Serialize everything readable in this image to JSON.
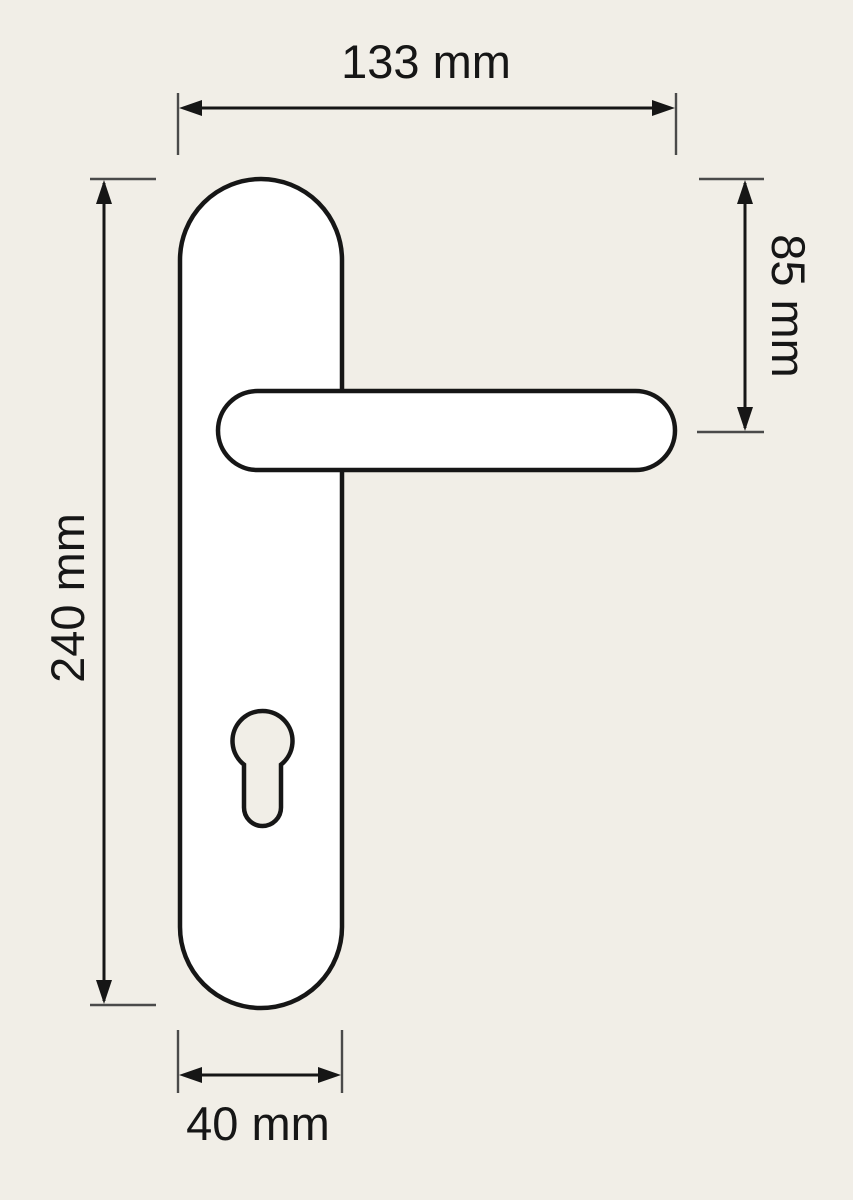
{
  "drawing": {
    "subject": "door handle with backplate, lever and euro-cylinder keyhole",
    "parts": {
      "backplate": "backplate",
      "lever": "lever-handle",
      "keyhole": "euro-cylinder-keyhole"
    },
    "dimensions": {
      "top": {
        "label": "133 mm",
        "value": 133,
        "unit": "mm",
        "measures": "overall width including lever"
      },
      "right": {
        "label": "85 mm",
        "value": 85,
        "unit": "mm",
        "measures": "plate top to lever axis"
      },
      "left": {
        "label": "240 mm",
        "value": 240,
        "unit": "mm",
        "measures": "plate height"
      },
      "bottom": {
        "label": "40 mm",
        "value": 40,
        "unit": "mm",
        "measures": "plate width"
      }
    },
    "colors": {
      "background": "#f1eee7",
      "part_fill": "#ffffff",
      "line": "#161616",
      "extension_line": "#4a4a4a"
    }
  }
}
